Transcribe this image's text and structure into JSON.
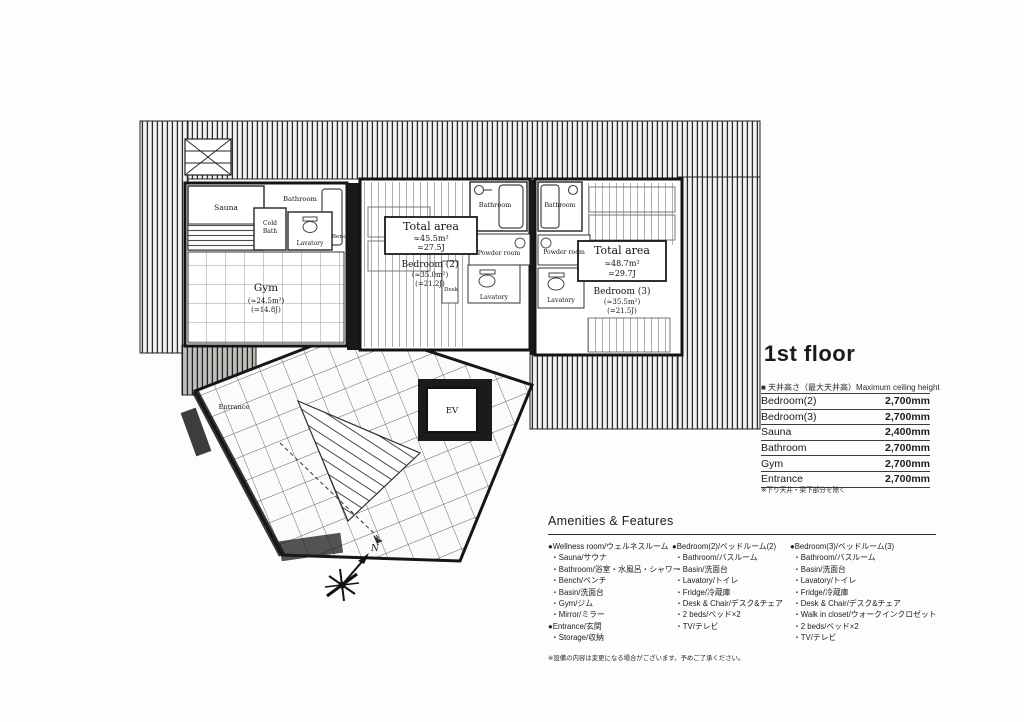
{
  "floor": {
    "title": "1st floor"
  },
  "ceiling_table": {
    "header": "■ 天井高さ（最大天井高）Maximum ceiling height",
    "rows": [
      {
        "room": "Bedroom(2)",
        "height": "2,700mm"
      },
      {
        "room": "Bedroom(3)",
        "height": "2,700mm"
      },
      {
        "room": "Sauna",
        "height": "2,400mm"
      },
      {
        "room": "Bathroom",
        "height": "2,700mm"
      },
      {
        "room": "Gym",
        "height": "2,700mm"
      },
      {
        "room": "Entrance",
        "height": "2,700mm"
      }
    ],
    "note": "※下り天井・梁下部分を除く"
  },
  "amenities": {
    "title": "Amenities & Features",
    "col1": {
      "group1_heading": "●Wellness room/ウェルネスルーム",
      "group1_items": [
        "・Sauna/サウナ",
        "・Bathroom/浴室・水風呂・シャワー",
        "・Bench/ベンチ",
        "・Basin/洗面台",
        "・Gym/ジム",
        "・Mirror/ミラー"
      ],
      "group2_heading": "●Entrance/玄関",
      "group2_items": [
        "・Storage/収納"
      ]
    },
    "col2": {
      "heading": "●Bedroom(2)/ベッドルーム(2)",
      "items": [
        "・Bathroom/バスルーム",
        "・Basin/洗面台",
        "・Lavatory/トイレ",
        "・Fridge/冷蔵庫",
        "・Desk & Chair/デスク&チェア",
        "・2 beds/ベッド×2",
        "・TV/テレビ"
      ]
    },
    "col3": {
      "heading": "●Bedroom(3)/ベッドルーム(3)",
      "items": [
        "・Bathroom/バスルーム",
        "・Basin/洗面台",
        "・Lavatory/トイレ",
        "・Fridge/冷蔵庫",
        "・Desk & Chair/デスク&チェア",
        "・Walk in closet/ウォークインクロゼット",
        "・2 beds/ベッド×2",
        "・TV/テレビ"
      ]
    },
    "note": "※設備の内容は変更になる場合がございます。予めご了承ください。"
  },
  "floorplan": {
    "compass": "N",
    "labels": {
      "sauna": "Sauna",
      "bathroom_wellness": "Bathroom",
      "cold_bath_line1": "Cold",
      "cold_bath_line2": "Bath",
      "lavatory_wellness": "Lavatory",
      "bench": "Bench",
      "gym_name": "Gym",
      "gym_area": "(≈24.5m²)",
      "gym_tatami": "(=14.8J)",
      "total2_title": "Total area",
      "total2_area": "≈45.5m²",
      "total2_tatami": "=27.5J",
      "bedroom2_name": "Bedroom (2)",
      "bedroom2_area": "(≈35.0m²)",
      "bedroom2_tatami": "(=21.2J)",
      "bathroom2": "Bathroom",
      "powder2": "Powder room",
      "desk": "Desk",
      "lavatory2": "Lavatory",
      "bathroom3": "Bathroom",
      "powder3": "Powder room",
      "lavatory3": "Lavatory",
      "total3_title": "Total area",
      "total3_area": "≈48.7m²",
      "total3_tatami": "=29.7J",
      "bedroom3_name": "Bedroom (3)",
      "bedroom3_area": "(≈35.5m²)",
      "bedroom3_tatami": "(=21.5J)",
      "entrance": "Entrance",
      "elevator": "EV"
    }
  }
}
